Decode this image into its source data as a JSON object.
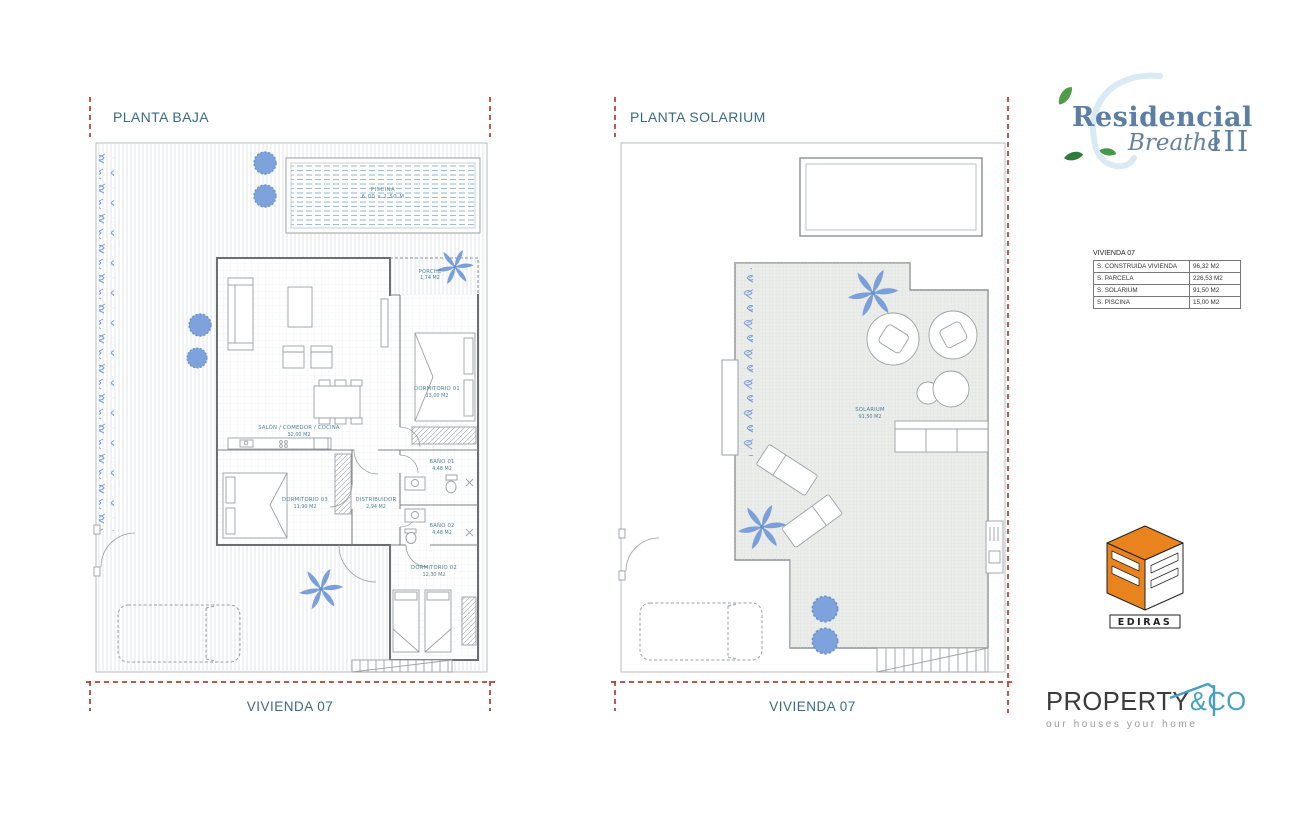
{
  "colors": {
    "title_text": "#3a6b85",
    "room_label": "#4e7f96",
    "red_dash": "#b23b2e",
    "plant_blue": "#7b9fd9",
    "ediras_orange": "#e8831d",
    "property_teal": "#47a0c3"
  },
  "left_plan": {
    "title": "PLANTA BAJA",
    "caption": "VIVIENDA 07",
    "pool": {
      "name": "PISCINA",
      "dim": "6,00 x 2,50 M"
    },
    "rooms": {
      "porche": {
        "name": "PORCHE",
        "area": "1,74 M2"
      },
      "salon": {
        "name": "SALÓN / COMEDOR / COCINA",
        "area": "32,00 M2"
      },
      "dormitorio1": {
        "name": "DORMITORIO 01",
        "area": "13,00 M2"
      },
      "bano1": {
        "name": "BAÑO 01",
        "area": "4,48 M2"
      },
      "dormitorio3": {
        "name": "DORMITORIO 03",
        "area": "11,90 M2"
      },
      "distribuidor": {
        "name": "DISTRIBUIDOR",
        "area": "2,94 M2"
      },
      "bano2": {
        "name": "BAÑO 02",
        "area": "4,48 M2"
      },
      "dormitorio2": {
        "name": "DORMITORIO 02",
        "area": "12,30 M2"
      }
    }
  },
  "right_plan": {
    "title": "PLANTA SOLARIUM",
    "caption": "VIVIENDA 07",
    "rooms": {
      "solarium": {
        "name": "SOLARIUM",
        "area": "91,50 M2"
      }
    }
  },
  "summary_table": {
    "title": "VIVIENDA 07",
    "rows": [
      {
        "label": "S. CONSTRUIDA VIVIENDA",
        "value": "96,32 M2"
      },
      {
        "label": "S. PARCELA",
        "value": "226,53 M2"
      },
      {
        "label": "S. SOLARIUM",
        "value": "91,50 M2"
      },
      {
        "label": "S. PISCINA",
        "value": "15,00 M2"
      }
    ]
  },
  "branding": {
    "residencial": {
      "name": "Residencial",
      "sub": "Breathe",
      "numeral": "III"
    },
    "ediras": {
      "label": "EDIRAS"
    },
    "property": {
      "name": "PROPERTY",
      "suffix": "&CO",
      "tagline": "our houses your home"
    }
  }
}
